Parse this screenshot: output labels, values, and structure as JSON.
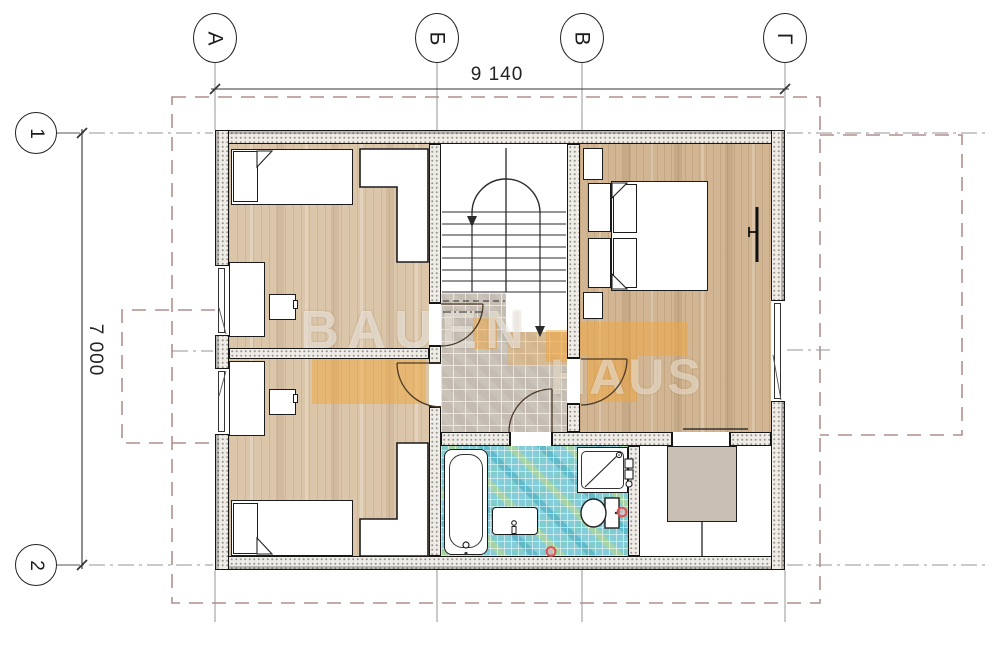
{
  "axes": {
    "columns": [
      {
        "label": "А"
      },
      {
        "label": "Б"
      },
      {
        "label": "В"
      },
      {
        "label": "Г"
      }
    ],
    "rows": [
      {
        "label": "1"
      },
      {
        "label": "2"
      }
    ]
  },
  "dimensions": {
    "overall_width": "9 140",
    "overall_height": "7 000"
  },
  "watermark": {
    "line1": "BAUEN",
    "line2": "HAUS"
  },
  "palette": {
    "wood_floor": "#dbc6aa",
    "wood_floor_dark": "#d2b693",
    "hall_tile": "#cac3ba",
    "bath_mosaic": "#83ccd8",
    "wall_fill": "#efece7",
    "roof_dashed": "#b18f8d",
    "axis_line": "#969696",
    "watermark_orange": "#f0a64a",
    "drain_red": "#d95555",
    "storage_box_gray": "#c9c0b3",
    "line_dark": "#222222"
  }
}
